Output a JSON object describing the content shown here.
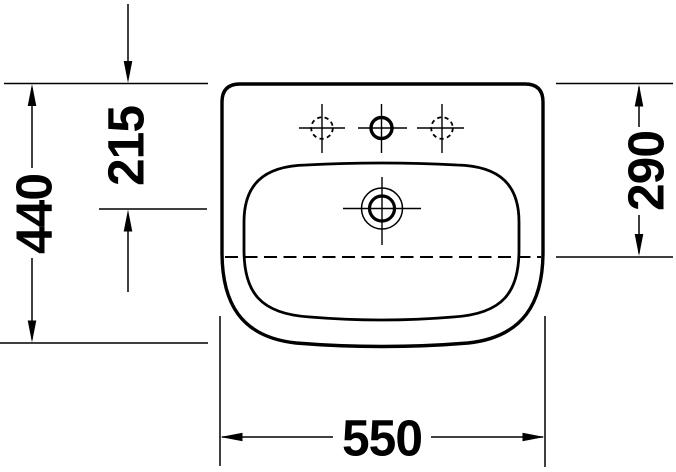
{
  "colors": {
    "ink": "#000000",
    "paper": "#ffffff"
  },
  "dimension_labels": {
    "overall_depth": "440",
    "tap_hole_offset": "215",
    "overflow_line_depth": "290",
    "overall_width": "550"
  }
}
